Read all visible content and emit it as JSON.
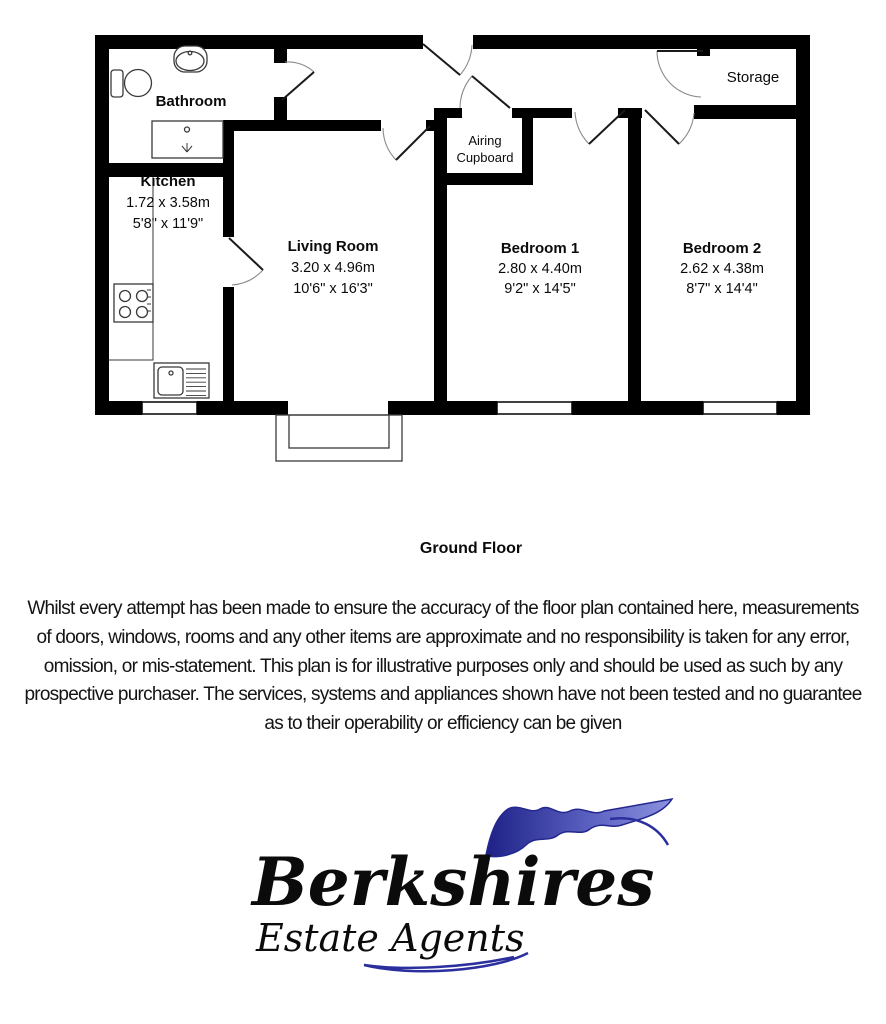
{
  "floor_plan": {
    "title": "Ground Floor",
    "rooms": {
      "bathroom": {
        "name": "Bathroom"
      },
      "kitchen": {
        "name": "Kitchen",
        "metric": "1.72 x 3.58m",
        "imperial": "5'8\" x 11'9\""
      },
      "living_room": {
        "name": "Living Room",
        "metric": "3.20 x 4.96m",
        "imperial": "10'6\" x 16'3\""
      },
      "airing_cupboard": {
        "name_line1": "Airing",
        "name_line2": "Cupboard"
      },
      "bedroom_1": {
        "name": "Bedroom 1",
        "metric": "2.80 x 4.40m",
        "imperial": "9'2\" x 14'5\""
      },
      "bedroom_2": {
        "name": "Bedroom 2",
        "metric": "2.62 x 4.38m",
        "imperial": "8'7\" x 14'4\""
      },
      "storage": {
        "name": "Storage"
      }
    }
  },
  "disclaimer": {
    "lines": [
      "Whilst every attempt has been made to ensure the accuracy of the floor plan contained here, measurements",
      "of doors, windows, rooms and any other items are approximate and no responsibility is taken for any error,",
      "omission, or mis-statement. This plan is for illustrative purposes only and should be used as such by any",
      "prospective purchaser. The services, systems and appliances shown have not been tested and no guarantee",
      "as to their operability or efficiency can be given"
    ]
  },
  "logo": {
    "brand": "Berkshires",
    "tagline": "Estate Agents"
  },
  "colors": {
    "wall": "#000000",
    "logo_blue": "#2b2f9e",
    "background": "#ffffff"
  }
}
